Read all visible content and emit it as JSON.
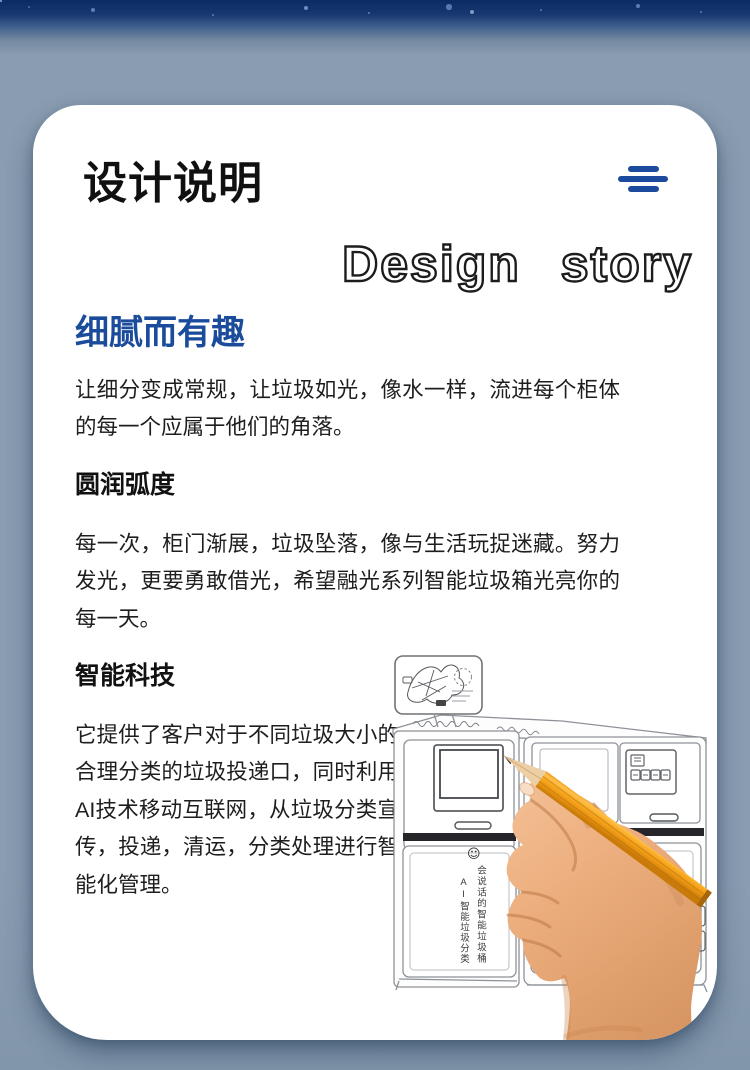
{
  "header": {
    "title": "设计说明",
    "menu_icon": "menu-lines-icon",
    "subtitle_en": "Design story"
  },
  "sections": [
    {
      "heading": "细腻而有趣",
      "body": "让细分变成常规，让垃圾如光，像水一样，流进每个柜体的每一个应属于他们的角落。"
    },
    {
      "heading": "圆润弧度",
      "body": "每一次，柜门渐展，垃圾坠落，像与生活玩捉迷藏。努力发光，更要勇敢借光，希望融光系列智能垃圾箱光亮你的每一天。"
    },
    {
      "heading": "智能科技",
      "body": "它提供了客户对于不同垃圾大小的合理分类的垃圾投递口，同时利用AI技术移动互联网，从垃圾分类宣传，投递，清运，分类处理进行智能化管理。"
    }
  ],
  "illustration": {
    "smiley_icon": "☺",
    "bin_label_primary": "会说话的智能垃圾桶",
    "bin_label_secondary": "AI智能垃圾分类"
  },
  "colors": {
    "accent_blue": "#1b4b9b",
    "menu_blue": "#1c4a9c",
    "background_blue_gray": "#8a9cb0",
    "top_band_navy": "#0b2b64",
    "card_white": "#ffffff",
    "pencil_orange": "#f6a21d"
  }
}
